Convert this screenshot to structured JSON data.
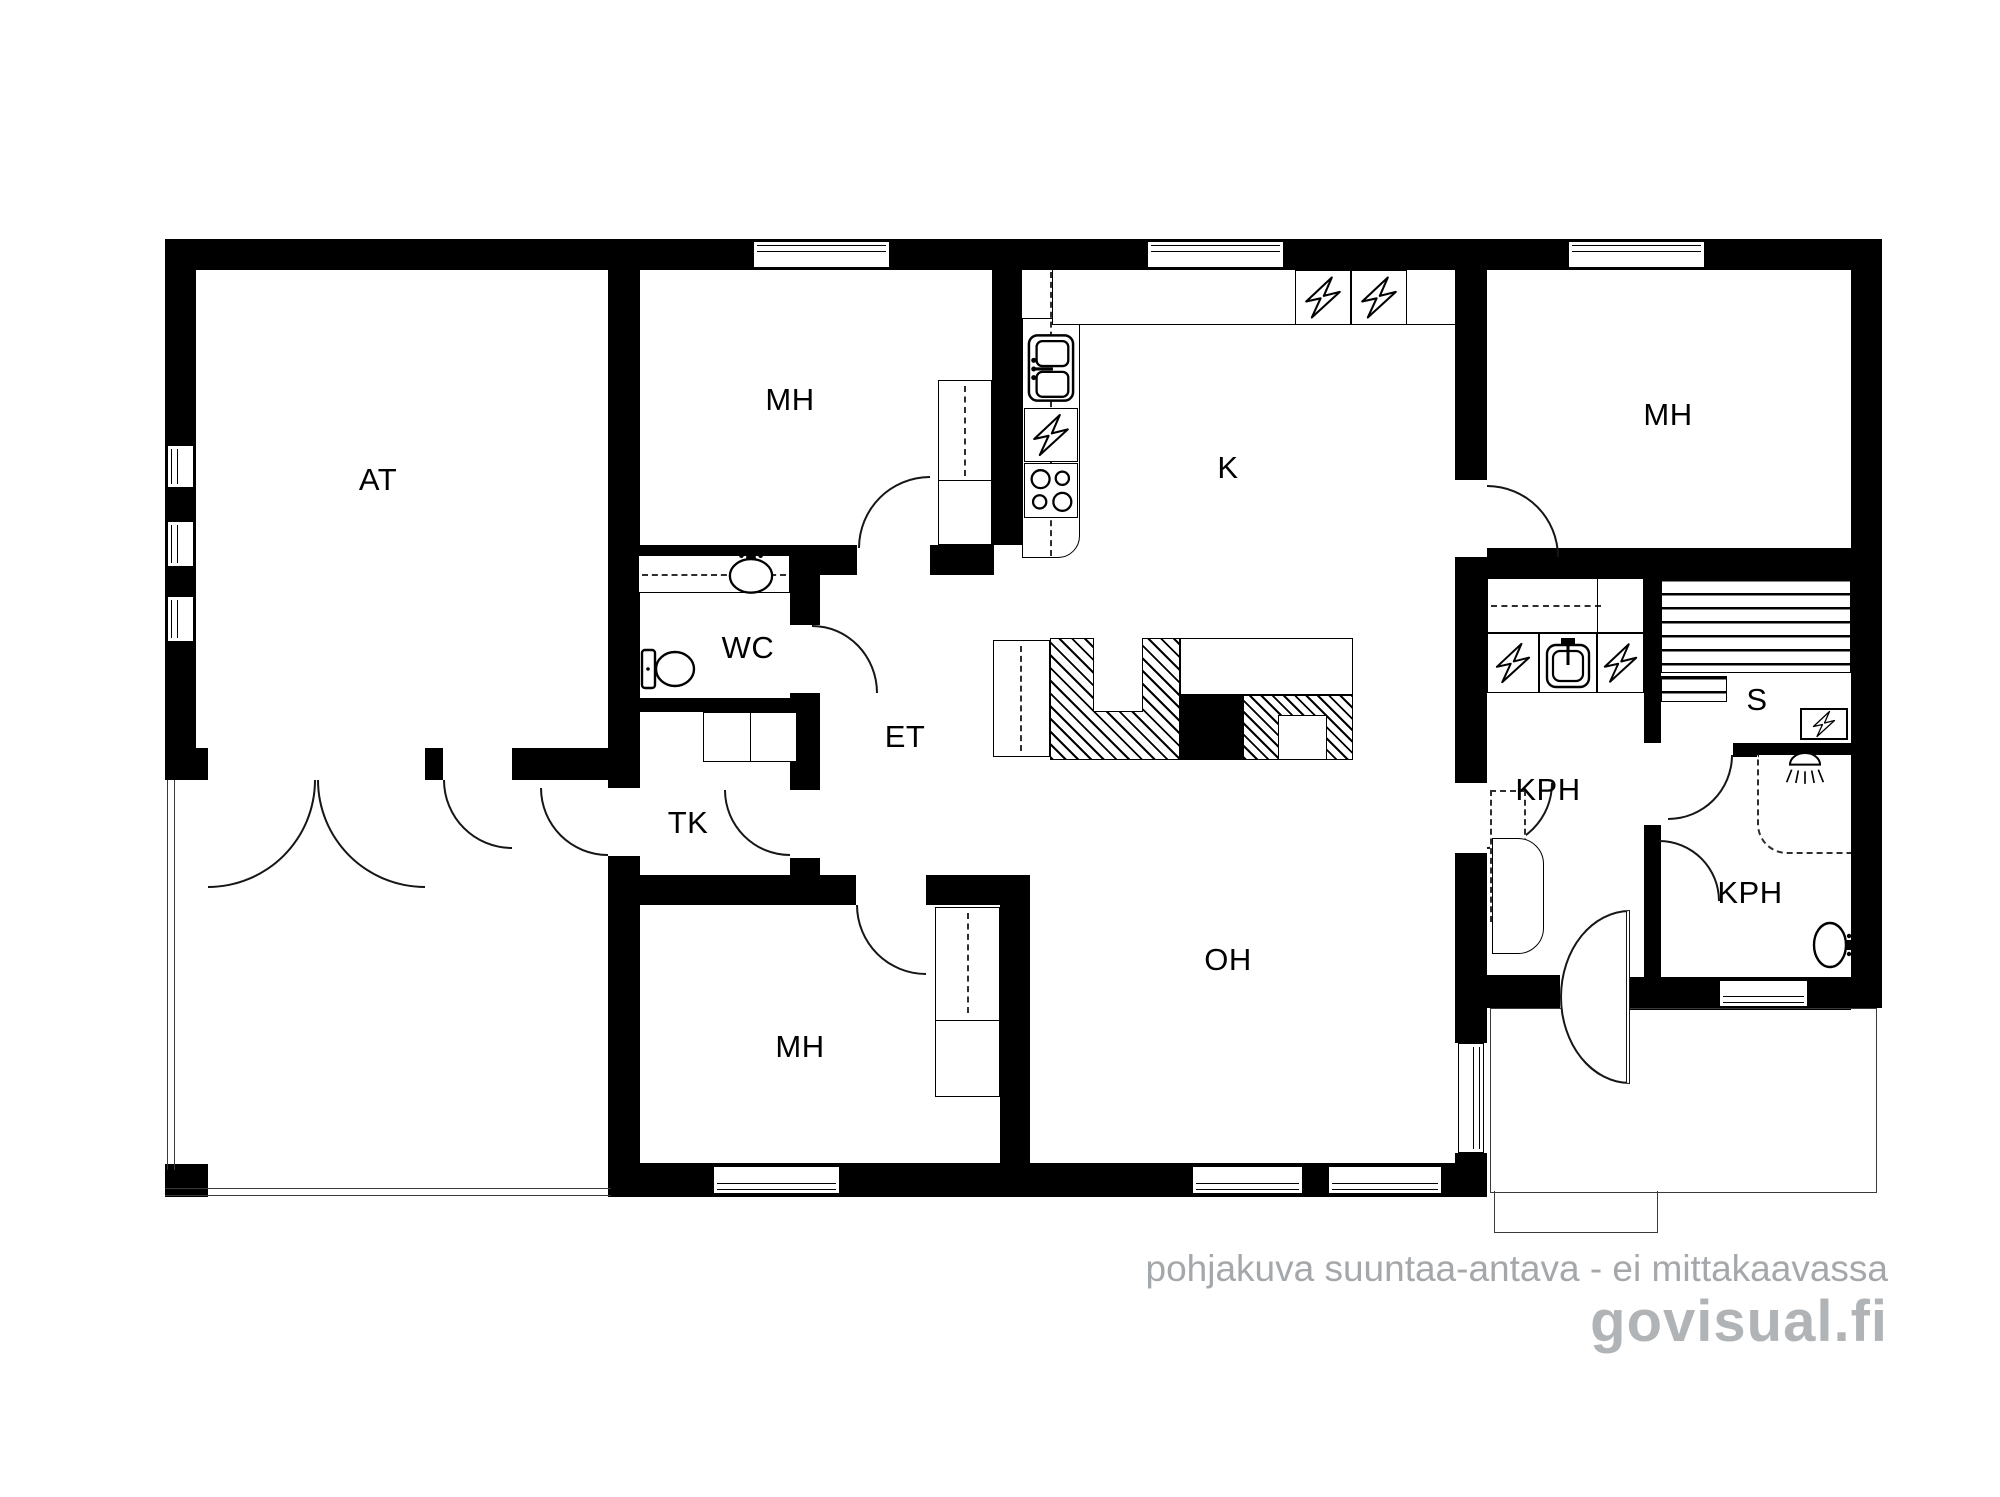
{
  "title": "floor-plan",
  "rooms": [
    {
      "id": "at",
      "label": "AT"
    },
    {
      "id": "mh-top",
      "label": "MH"
    },
    {
      "id": "k",
      "label": "K"
    },
    {
      "id": "mh-right",
      "label": "MH"
    },
    {
      "id": "wc",
      "label": "WC"
    },
    {
      "id": "et",
      "label": "ET"
    },
    {
      "id": "tk",
      "label": "TK"
    },
    {
      "id": "s",
      "label": "S"
    },
    {
      "id": "kph-left",
      "label": "KPH"
    },
    {
      "id": "oh",
      "label": "OH"
    },
    {
      "id": "mh-bottom",
      "label": "MH"
    },
    {
      "id": "kph-right",
      "label": "KPH"
    }
  ],
  "footer": {
    "disclaimer": "pohjakuva suuntaa-antava - ei mittakaavassa",
    "brand": "govisual.fi"
  },
  "icons": {
    "appliance": "lightning-bolt-icon",
    "sauna_stove": "lightning-bolt-icon",
    "shower": "shower-head-icon",
    "toilet": "toilet-icon",
    "kitchen_sink": "double-basin-sink-icon",
    "laundry_sink": "square-sink-icon",
    "wash_basin": "oval-basin-icon"
  },
  "colors": {
    "wall": "#000000",
    "line": "#161616",
    "disclaimer_text": "#a5a8ab",
    "brand_text": "#b1b4b7"
  }
}
